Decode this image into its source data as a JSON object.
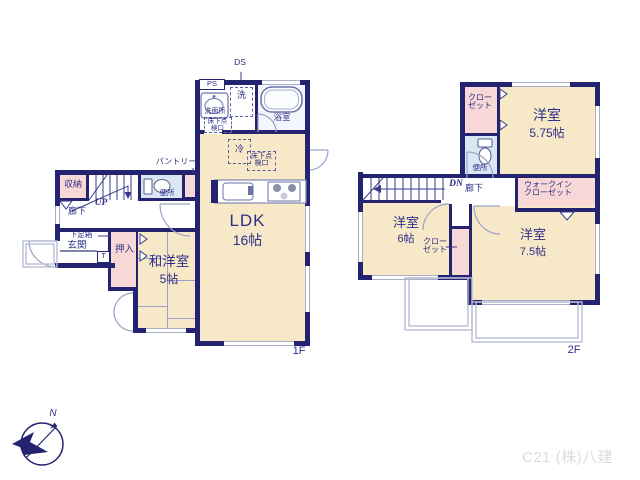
{
  "colors": {
    "wall_navy": "#23236f",
    "room_cream": "#f7e9c7",
    "closet_pink": "#f8d8d6",
    "toilet_blue": "#dbe6f5",
    "balcony_gray": "#b9bdd4",
    "text_navy": "#2e2e8a"
  },
  "floor1": {
    "floor_label": "1F",
    "ldk": {
      "name": "LDK",
      "size": "16帖"
    },
    "japanese_room": {
      "name": "和洋室",
      "size": "5帖"
    },
    "bath": "浴室",
    "washroom": "洗面所",
    "washer": "洗",
    "ps": "PS",
    "ds": "DS",
    "underfloor_hatch": "床下点検口",
    "fridge": "冷",
    "pantry": "パントリー",
    "toilet": "便所",
    "storage": "収納",
    "stairs": "UP",
    "hall": "廊下",
    "shoe_box": "下足箱",
    "tile": "T",
    "entrance": "玄関",
    "closet": "押入"
  },
  "floor2": {
    "floor_label": "2F",
    "bedroom_575": {
      "name": "洋室",
      "size": "5.75帖"
    },
    "bedroom_6": {
      "name": "洋室",
      "size": "6帖"
    },
    "bedroom_75": {
      "name": "洋室",
      "size": "7.5帖"
    },
    "closet_a": "クローゼット",
    "closet_b": "クローゼット",
    "walkin_closet": "ウォークインクローゼット",
    "toilet": "便所",
    "stairs": "DN",
    "hall": "廊下"
  },
  "compass": {
    "north": "N"
  },
  "credit": "C21 (株)八建"
}
